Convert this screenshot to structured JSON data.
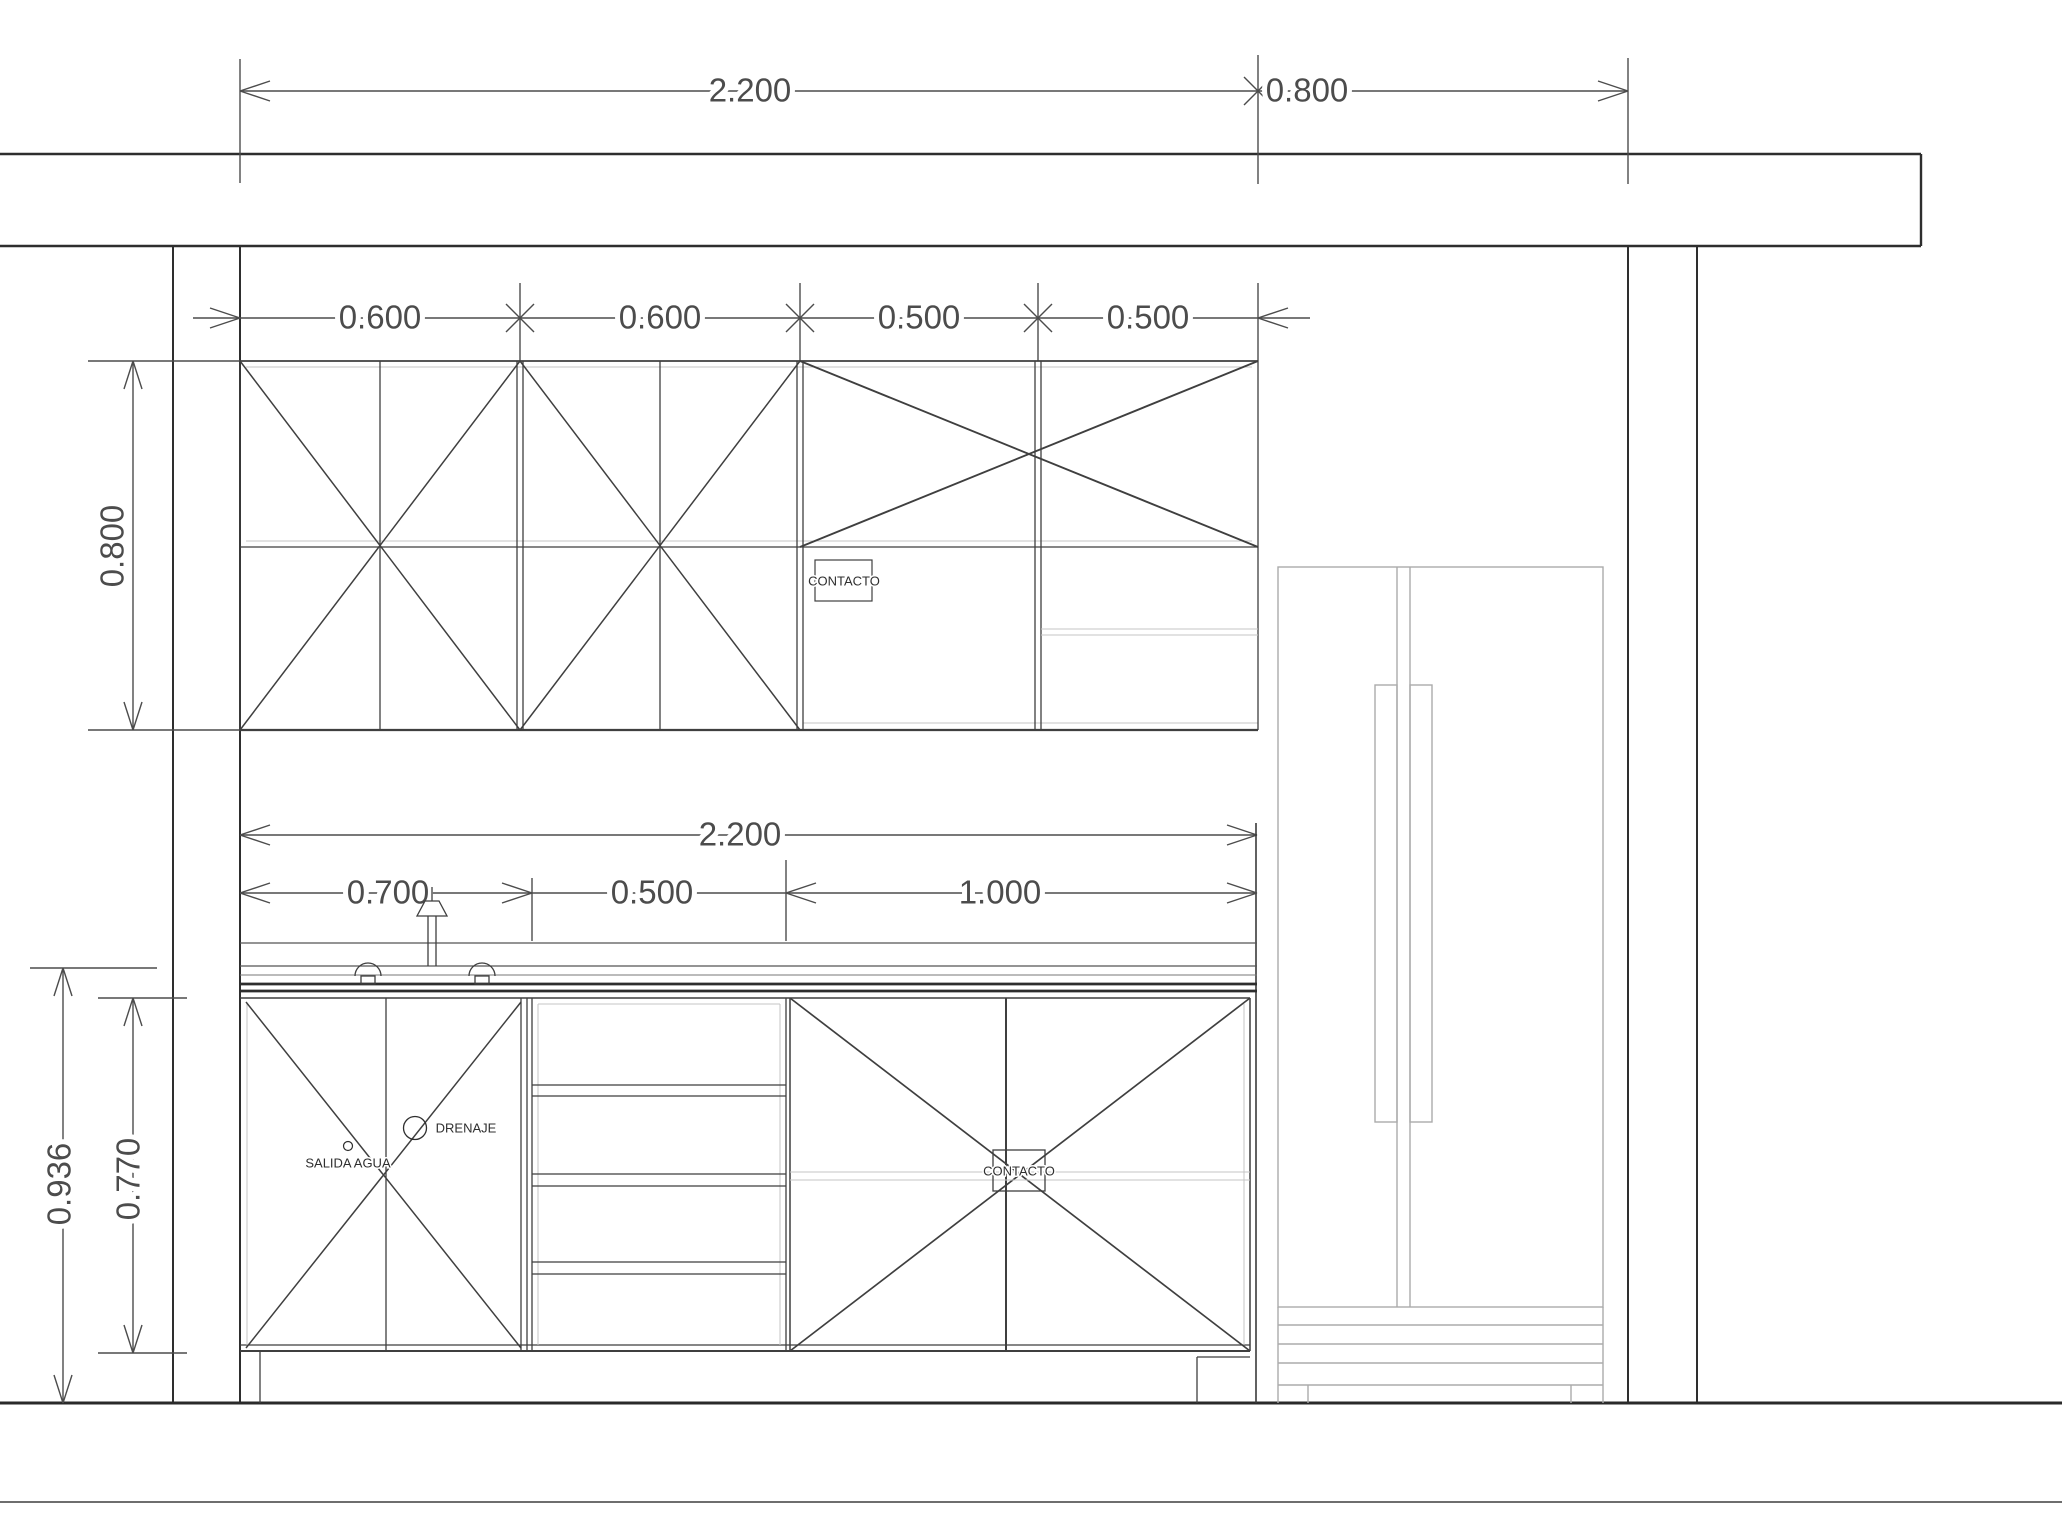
{
  "drawing": {
    "type": "kitchen-cabinet-elevation",
    "dims": {
      "top_span": "2.200",
      "top_right_span": "0.800",
      "upper_units": [
        "0.600",
        "0.600",
        "0.500",
        "0.500"
      ],
      "upper_cabinet_height": "0.800",
      "mid_span": "2.200",
      "lower_units": [
        "0.700",
        "0.500",
        "1.000"
      ],
      "counter_total_height": "0.936",
      "base_cabinet_height": "0.770"
    },
    "labels": {
      "upper_outlet": "CONTACTO",
      "lower_outlet": "CONTACTO",
      "water_supply": "SALIDA AGUA",
      "drain": "DRENAJE"
    },
    "colors": {
      "background": "#ffffff",
      "structure_line": "#2e2e2e",
      "cabinet_line": "#3f3f3f",
      "dimension_line": "#4c4c4c",
      "light_line": "#c4c4c4",
      "appliance_line": "#ababab"
    }
  }
}
